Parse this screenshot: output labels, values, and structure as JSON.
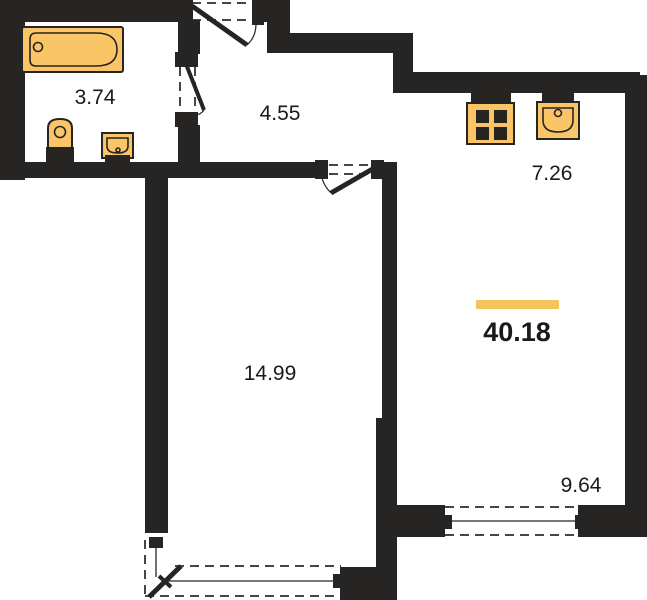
{
  "plan": {
    "title": "apartment-floor-plan",
    "total_area": "40.18",
    "rooms": [
      {
        "id": "bathroom",
        "area": "3.74"
      },
      {
        "id": "hallway",
        "area": "4.55"
      },
      {
        "id": "kitchen",
        "area": "7.26"
      },
      {
        "id": "bedroom",
        "area": "14.99"
      },
      {
        "id": "living-zone",
        "area": "9.64"
      }
    ],
    "fixtures": [
      "bathtub",
      "toilet",
      "wash-basin",
      "stove",
      "kitchen-sink"
    ],
    "openings": [
      "entrance-door",
      "bathroom-door",
      "bedroom-door",
      "balcony-door",
      "living-window",
      "balcony-window"
    ],
    "colors": {
      "wall": "#272424",
      "fixture": "#F9C566",
      "accent": "#F2C45C",
      "text": "#1A1A1A",
      "bg": "#FFFFFF"
    }
  }
}
